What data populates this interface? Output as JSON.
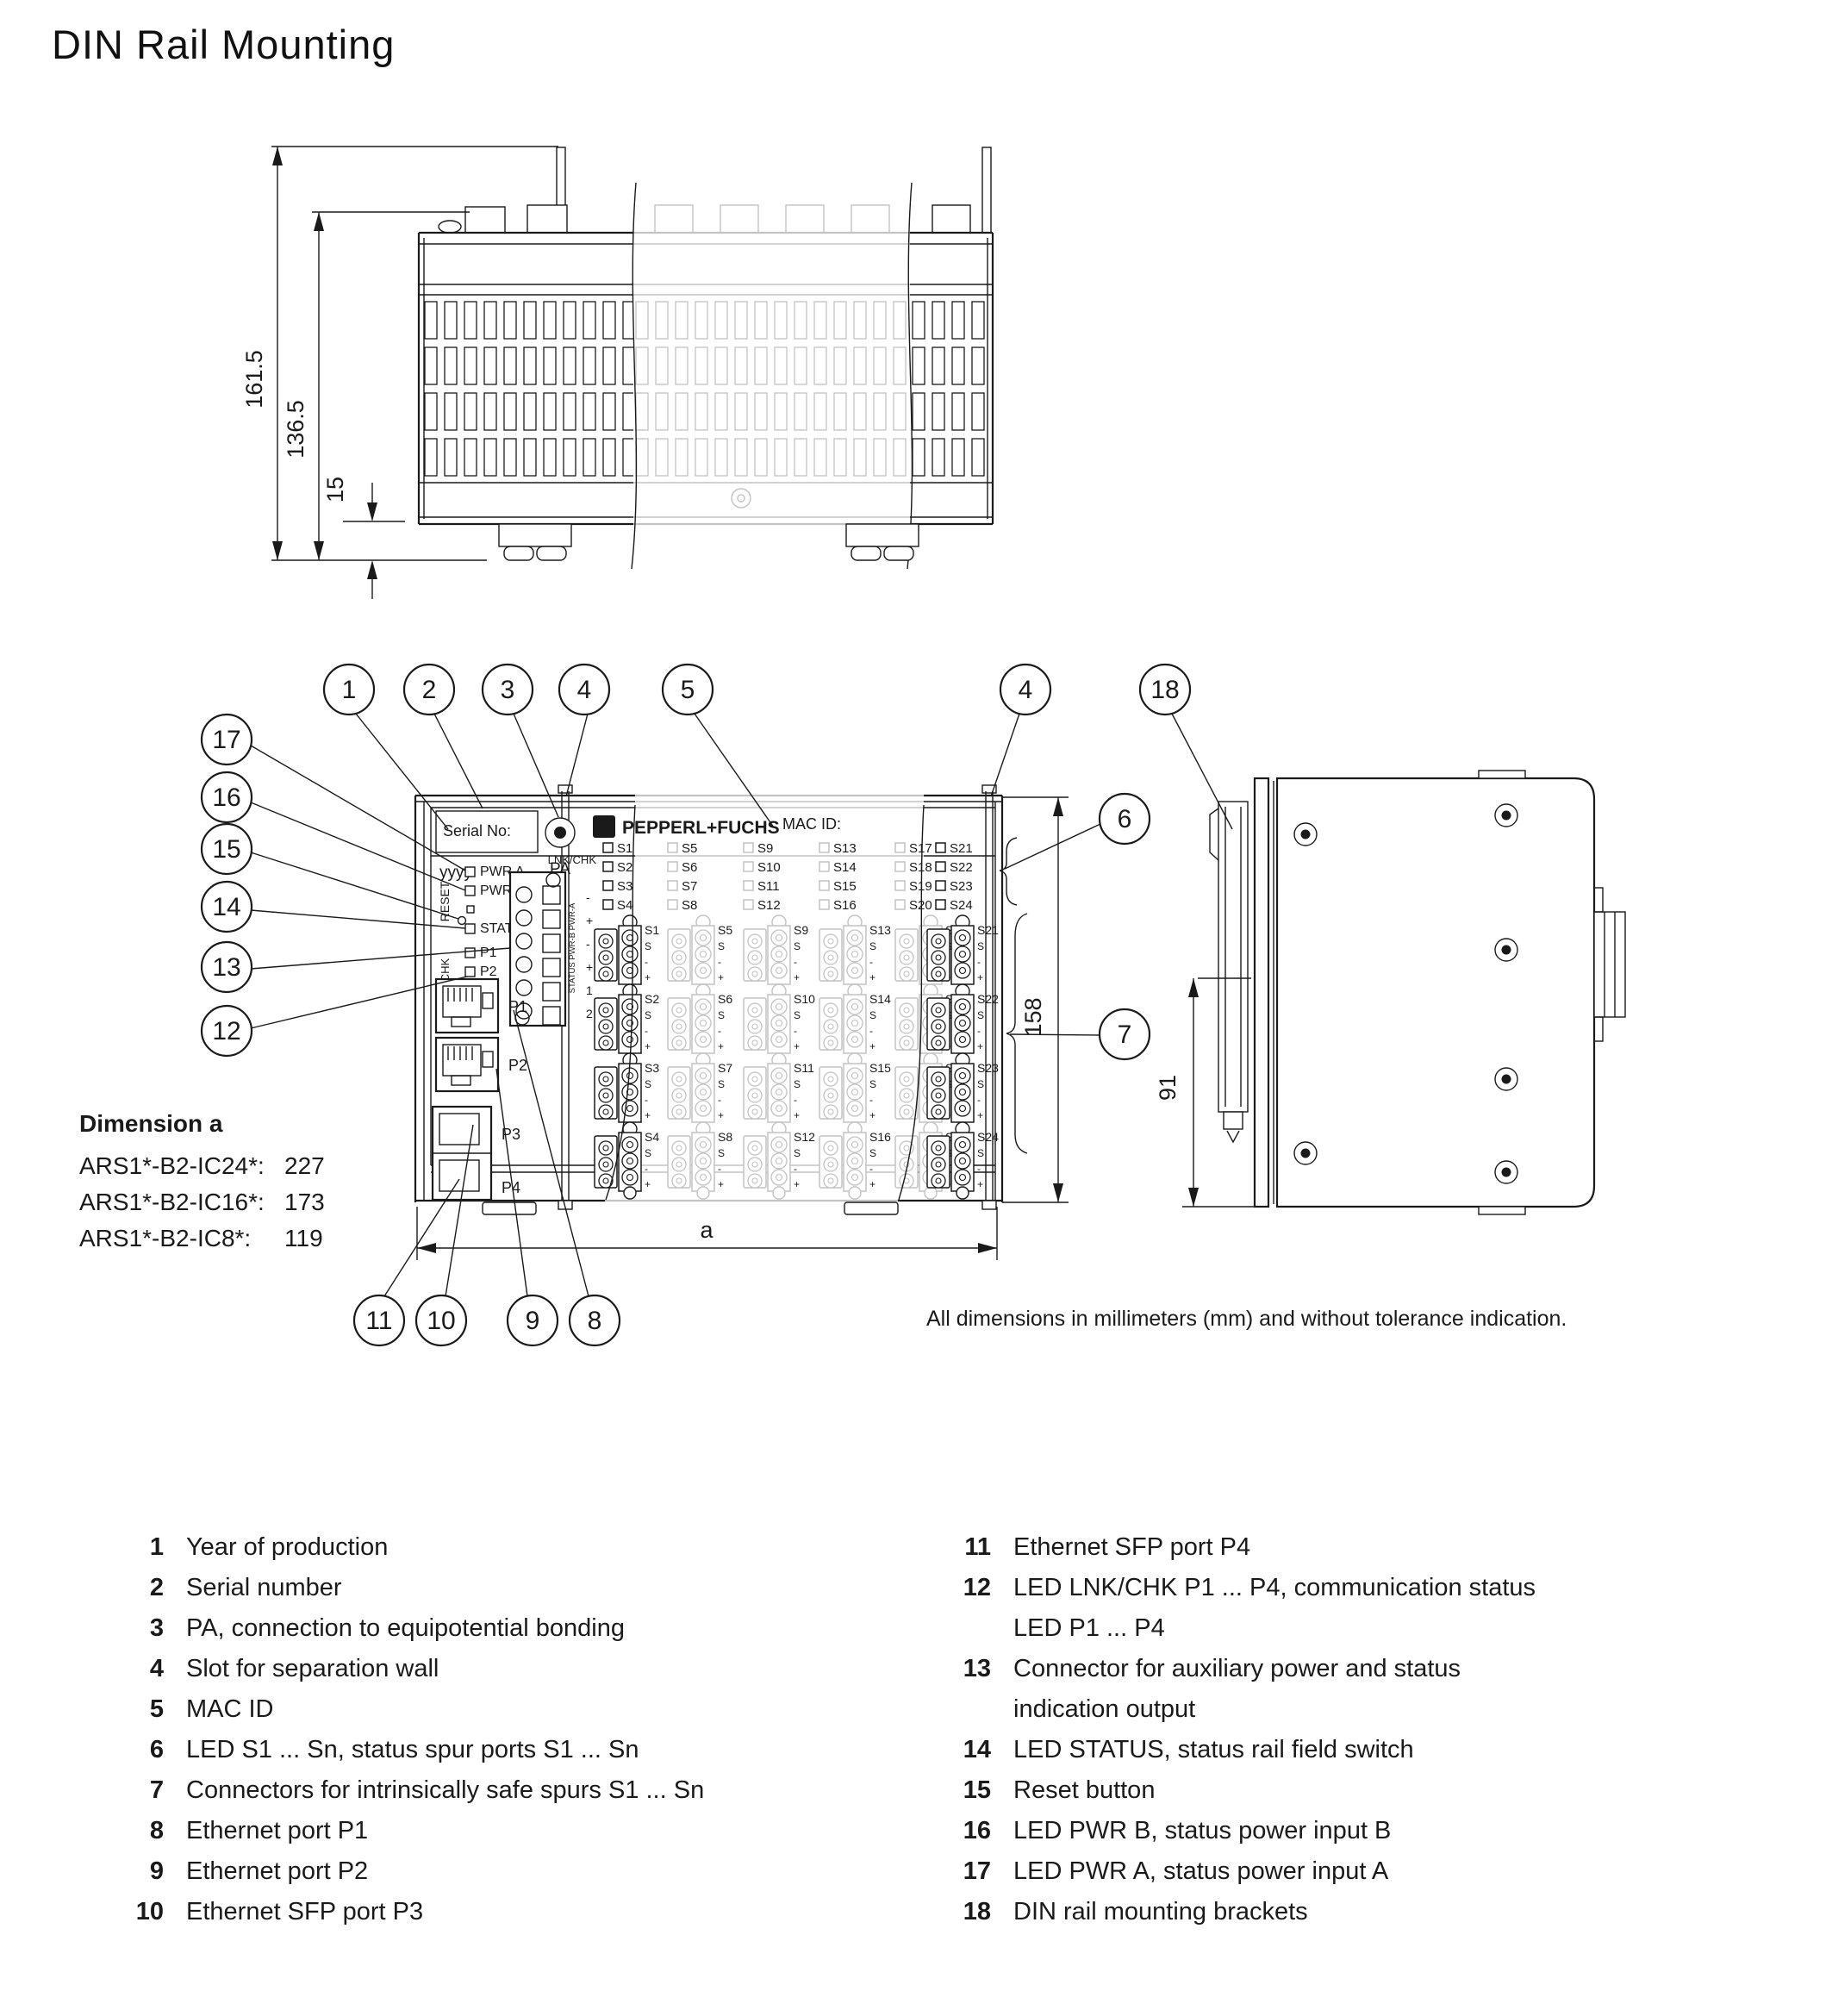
{
  "title": "DIN Rail Mounting",
  "colors": {
    "ink": "#1a1a1a",
    "faded": "#c3c3c3"
  },
  "top_view": {
    "dim_total": "161.5",
    "dim_body": "136.5",
    "dim_clip": "15"
  },
  "front_view": {
    "serial_label": "Serial No:",
    "year_code": "yyyy",
    "pa_label": "PA",
    "brand": "PEPPERL+FUCHS",
    "brand_emblem": "F",
    "mac_label": "MAC ID:",
    "reset_label": "RESET",
    "lnkchk_side_label": "LNK/CHK",
    "lnkchk_label": "LNK/CHK",
    "led_labels": {
      "pwr_a": "PWR A",
      "pwr_b": "PWR B",
      "status": "STATUS"
    },
    "port_led_labels": [
      "P1",
      "P2",
      "P3",
      "P4"
    ],
    "spur_led_groups": {
      "left": [
        "S1",
        "S2",
        "S3",
        "S4"
      ],
      "faded": [
        [
          "S5",
          "S6",
          "S7",
          "S8"
        ],
        [
          "S9",
          "S10",
          "S11",
          "S12"
        ],
        [
          "S13",
          "S14",
          "S15",
          "S16"
        ],
        [
          "S17",
          "S18",
          "S19",
          "S20"
        ]
      ],
      "right": [
        "S21",
        "S22",
        "S23",
        "S24"
      ]
    },
    "aux_block_vertical_label": "STATUS PWR-B PWR-A",
    "aux_terminal_marks": [
      "-",
      "+",
      "-",
      "+",
      "1",
      "2"
    ],
    "ethernet_ports": [
      "P1",
      "P2"
    ],
    "sfp_ports": [
      "P3",
      "P4"
    ],
    "spur_connector_groups": {
      "left": [
        "S1",
        "S2",
        "S3",
        "S4"
      ],
      "faded": [
        [
          "S5",
          "S6",
          "S7",
          "S8"
        ],
        [
          "S9",
          "S10",
          "S11",
          "S12"
        ],
        [
          "S13",
          "S14",
          "S15",
          "S16"
        ],
        [
          "S17",
          "S18",
          "S19",
          "S20"
        ]
      ],
      "right": [
        "S21",
        "S22",
        "S23",
        "S24"
      ]
    },
    "spur_terminal_marks": [
      "S",
      "-",
      "+"
    ],
    "dim_height": "158",
    "dim_width_label": "a"
  },
  "side_view": {
    "dim_bracket_height": "91"
  },
  "callouts": {
    "top": [
      "1",
      "2",
      "3",
      "4",
      "5"
    ],
    "top_right": [
      "4",
      "18"
    ],
    "right": [
      "6",
      "7"
    ],
    "left": [
      "17",
      "16",
      "15",
      "14",
      "13",
      "12"
    ],
    "bottom": [
      "11",
      "10",
      "9",
      "8"
    ]
  },
  "dimension_a": {
    "heading": "Dimension a",
    "rows": [
      {
        "model": "ARS1*-B2-IC24*:",
        "value": "227"
      },
      {
        "model": "ARS1*-B2-IC16*:",
        "value": "173"
      },
      {
        "model": "ARS1*-B2-IC8*:",
        "value": "119"
      }
    ]
  },
  "note": "All dimensions in millimeters (mm) and without tolerance indication.",
  "legend": {
    "left": [
      {
        "num": "1",
        "text": "Year of production"
      },
      {
        "num": "2",
        "text": "Serial number"
      },
      {
        "num": "3",
        "text": "PA, connection to equipotential bonding"
      },
      {
        "num": "4",
        "text": "Slot for separation wall"
      },
      {
        "num": "5",
        "text": "MAC ID"
      },
      {
        "num": "6",
        "text": "LED S1 ... Sn, status spur ports S1 ... Sn"
      },
      {
        "num": "7",
        "text": "Connectors for intrinsically safe spurs S1 ... Sn"
      },
      {
        "num": "8",
        "text": "Ethernet port P1"
      },
      {
        "num": "9",
        "text": "Ethernet port P2"
      },
      {
        "num": "10",
        "text": "Ethernet SFP port P3"
      }
    ],
    "right": [
      {
        "num": "11",
        "text": "Ethernet SFP port P4"
      },
      {
        "num": "12",
        "text": "LED LNK/CHK P1 ... P4, communication status",
        "text2": "LED P1 ... P4"
      },
      {
        "num": "13",
        "text": "Connector for auxiliary power and status",
        "text2": "indication output"
      },
      {
        "num": "14",
        "text": "LED STATUS, status rail field switch"
      },
      {
        "num": "15",
        "text": "Reset button"
      },
      {
        "num": "16",
        "text": "LED PWR B, status power input B"
      },
      {
        "num": "17",
        "text": "LED PWR A, status power input A"
      },
      {
        "num": "18",
        "text": "DIN rail mounting brackets"
      }
    ]
  }
}
